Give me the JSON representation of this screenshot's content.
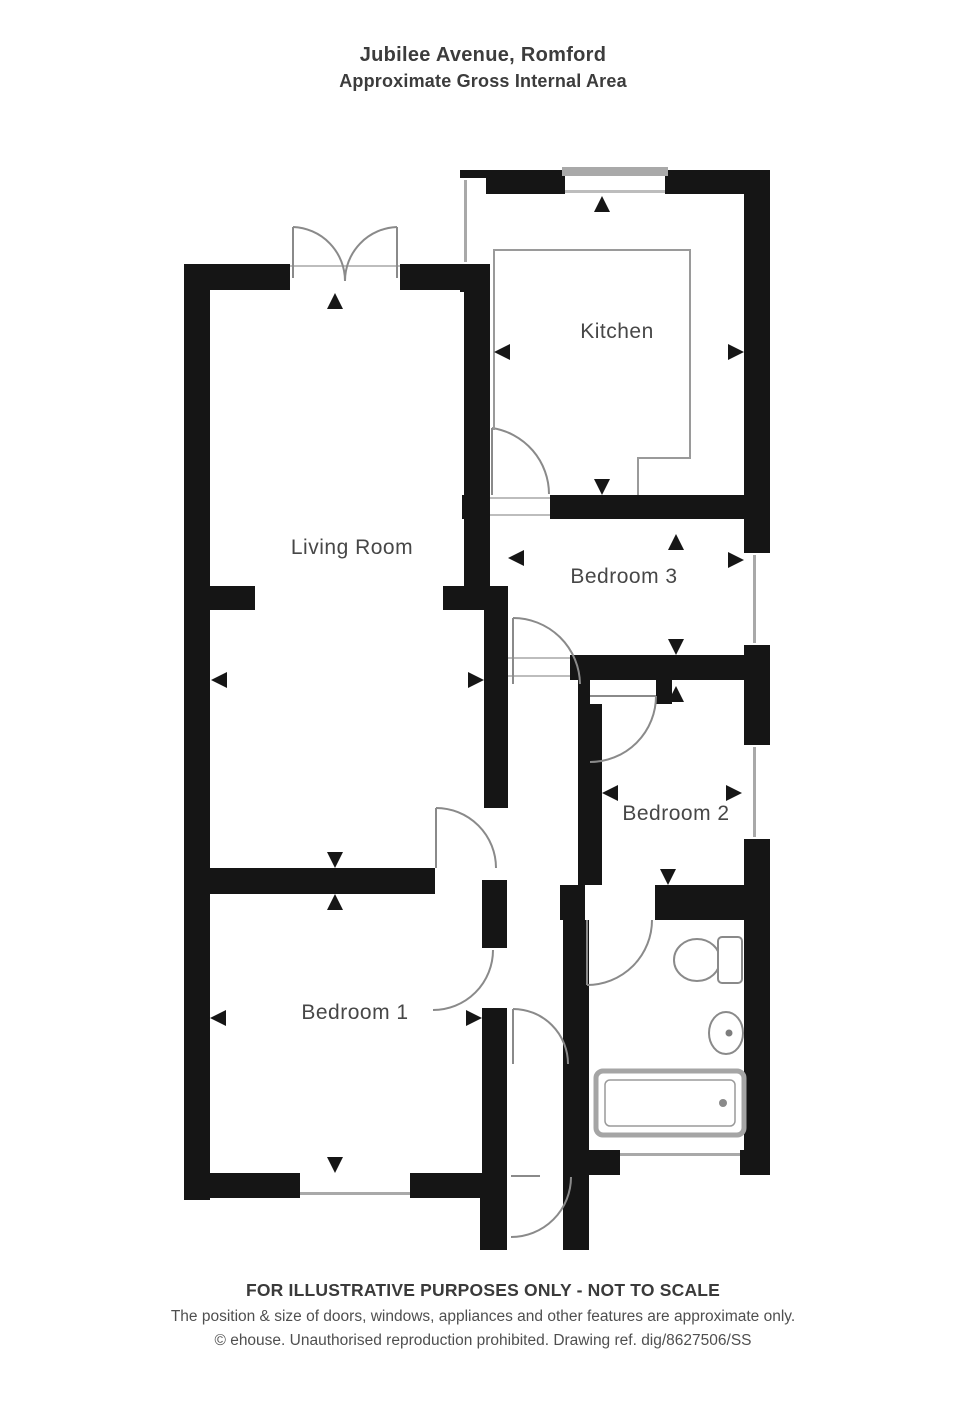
{
  "title": {
    "line1": "Jubilee Avenue, Romford",
    "line2": "Approximate Gross Internal Area"
  },
  "rooms": {
    "kitchen": {
      "label": "Kitchen"
    },
    "living": {
      "label": "Living Room"
    },
    "bedroom3": {
      "label": "Bedroom 3"
    },
    "bedroom2": {
      "label": "Bedroom 2"
    },
    "bedroom1": {
      "label": "Bedroom 1"
    }
  },
  "fixtures": {
    "toilet": "toilet",
    "sink": "sink",
    "bathtub": "bathtub",
    "kitchen_counter": "kitchen-counter"
  },
  "footer": {
    "line1": "FOR ILLUSTRATIVE PURPOSES ONLY - NOT TO SCALE",
    "line2": "The position & size of doors, windows, appliances and other features are approximate only.",
    "line3": "© ehouse. Unauthorised reproduction prohibited. Drawing ref. dig/8627506/SS"
  },
  "colors": {
    "wall": "#151515",
    "door_line": "#8a8a8a",
    "label": "#474747",
    "background": "#ffffff"
  }
}
